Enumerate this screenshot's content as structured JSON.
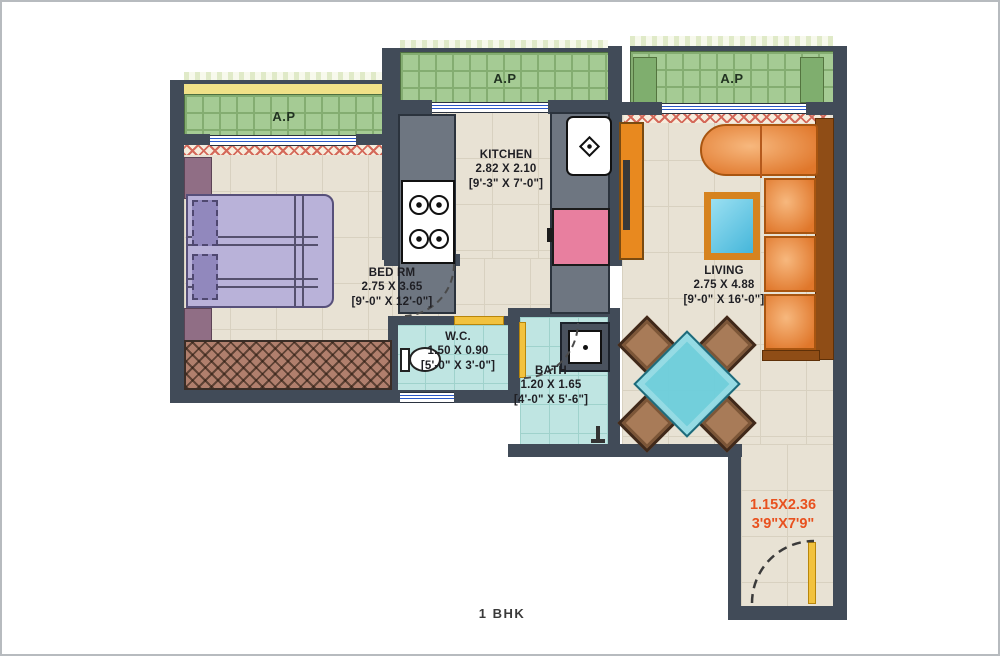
{
  "plan": {
    "balcony_bedroom": {
      "label": "A.P"
    },
    "balcony_kitchen": {
      "label": "A.P"
    },
    "balcony_living": {
      "label": "A.P"
    },
    "kitchen": {
      "name": "KITCHEN",
      "metric": "2.82 X 2.10",
      "imperial": "[9'-3\" X 7'-0\"]"
    },
    "bedroom": {
      "name": "BED RM",
      "metric": "2.75 X 3.65",
      "imperial": "[9'-0\" X 12'-0\"]"
    },
    "wc": {
      "name": "W.C.",
      "metric": "1.50 X 0.90",
      "imperial": "[5'-0\" X 3'-0\"]"
    },
    "bath": {
      "name": "BATH",
      "metric": "1.20 X 1.65",
      "imperial": "[4'-0\" X 5'-6\"]"
    },
    "living": {
      "name": "LIVING",
      "metric": "2.75 X 4.88",
      "imperial": "[9'-0\" X 16'-0\"]"
    },
    "entry_passage": {
      "metric": "1.15X2.36",
      "imperial": "3'9\"X7'9\""
    }
  },
  "footer": {
    "plan_type": "1 BHK"
  },
  "colors": {
    "wall": "#414b58",
    "floor": "#e8e2d4",
    "balcony_green": "#a5cb94",
    "wet_cyan": "#bfe5e2",
    "door_yellow": "#f2c23e",
    "accent_orange_text": "#e8511f",
    "sofa_orange": "#e0772b",
    "table_blue": "#6cced b"
  }
}
